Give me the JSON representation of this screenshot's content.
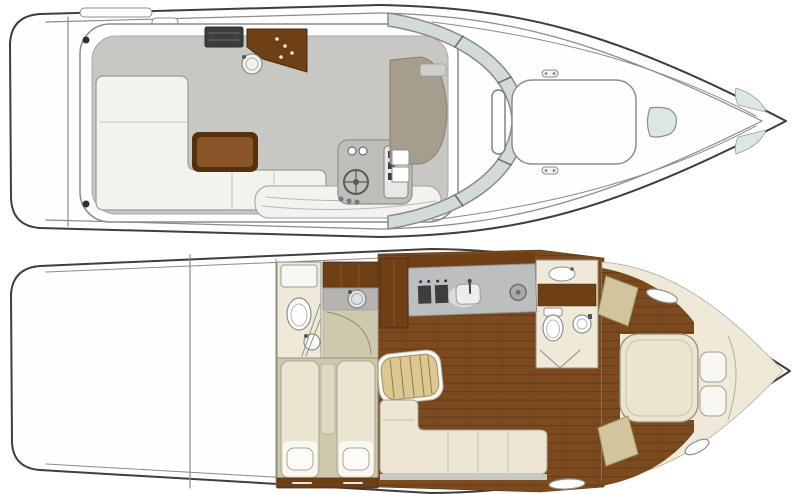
{
  "diagram": {
    "type": "yacht-deck-floor-plan",
    "views": [
      {
        "id": "main-deck",
        "features": [
          "swim-platform",
          "stern-cleats",
          "cockpit-settee",
          "cockpit-table",
          "wet-bar-grill",
          "wet-bar-counter",
          "wet-bar-sink",
          "helm-console",
          "steering-wheel",
          "instrument-panel",
          "windshield",
          "companionway",
          "companionway-steps",
          "grab-rail",
          "bow-sunpad",
          "mooring-cleats",
          "foredeck-hatch",
          "bow-lockers"
        ]
      },
      {
        "id": "lower-deck",
        "features": [
          "aft-head-toilet",
          "aft-head-cistern",
          "aft-head-sink",
          "shower-door",
          "wardrobe",
          "vanity-sink",
          "cabin-entry",
          "guest-cabin-twin-berths",
          "pillows",
          "dresser",
          "galley-counter",
          "galley-stove",
          "galley-sink",
          "galley-burner",
          "tall-cabinet",
          "companionway-steps",
          "salon-bench-settee",
          "teak-plank-floor",
          "forward-head-toilet",
          "forward-head-counter-sink",
          "forward-head-round-sink",
          "master-cabin-island-berth",
          "master-pillows",
          "corner-seats",
          "oval-hull-windows"
        ]
      }
    ]
  },
  "colors": {
    "line_dark": "#3f3e3c",
    "line_mid": "#8b8b87",
    "hull_white": "#fefefe",
    "deck_gray": "#c8c7c3",
    "walkway_white": "#f3f2ee",
    "console_gray": "#bfbeba",
    "taupe": "#a69d8e",
    "glass": "#d2dcd7",
    "hatch_glass": "#dbe8e1",
    "table_edge": "#55300f",
    "table_top": "#8a5526",
    "wood_floor": "#7c4a1e",
    "wood_line": "#653a14",
    "cabinet_brown": "#6f3f16",
    "cream": "#efe9da",
    "bed_cream": "#ebe4cf",
    "tan": "#d3c59b",
    "steps_tan": "#dbc892",
    "olive": "#ccc9ad",
    "counter_gray": "#bdbebf",
    "appliance_dark": "#3d3d3d",
    "white_soft": "#f9f7f1",
    "bench_cream": "#ece7d4",
    "strip_gray": "#c9c9c3",
    "fixture_stroke": "#8e8e8a"
  }
}
